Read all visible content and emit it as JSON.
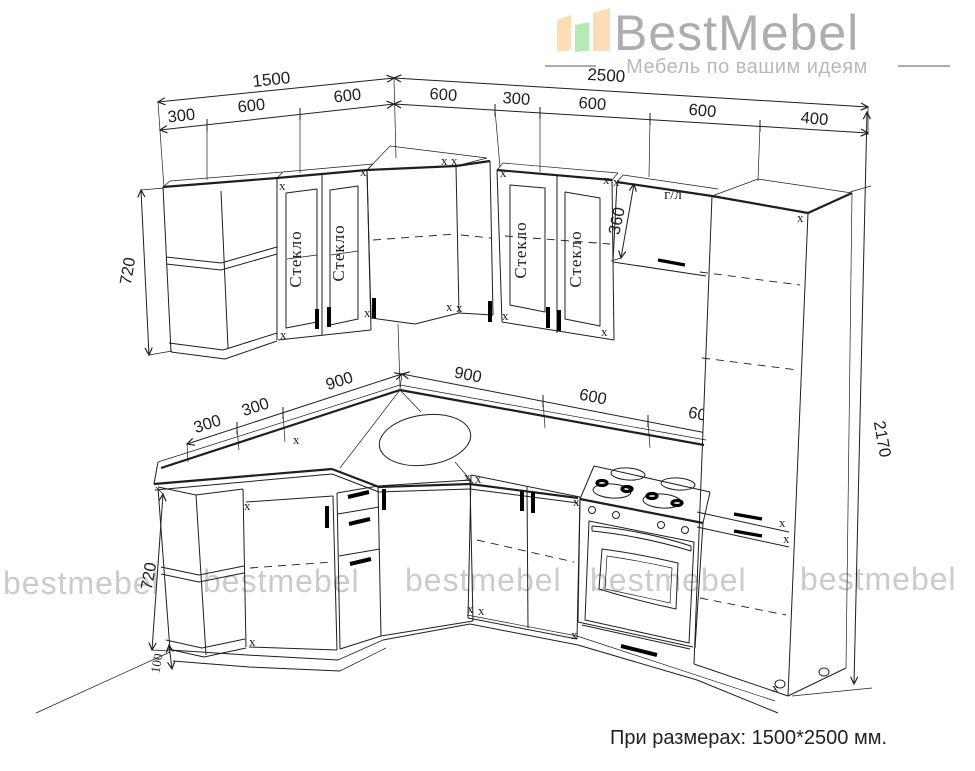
{
  "logo": {
    "name": "BestMebel",
    "tagline": "Мебель по вашим идеям"
  },
  "watermark": {
    "text": "bestmebel"
  },
  "footer": {
    "note": "При размерах: 1500*2500 мм."
  },
  "labels": {
    "glass": "Стекло",
    "gas_lift": "г/л",
    "corner_mark": "x"
  },
  "colors": {
    "line": "#1f1f1f",
    "watermark": "#cbcbcb",
    "logo_text": "#adadad",
    "logo_bar_left": "#fadeb4",
    "logo_bar_mid": "#b6eab4",
    "logo_bar_right": "#fcdeb6",
    "tagline": "#b9b9b9"
  },
  "dims": {
    "left_wall_total": "1500",
    "right_wall_total": "2500",
    "left_wall_segments": [
      "300",
      "600",
      "600"
    ],
    "right_wall_segments": [
      "600",
      "300",
      "600",
      "600",
      "400"
    ],
    "wall_cabinet_height": "720",
    "gas_lift_cabinet_height": "360",
    "tall_cabinet_height": "2170",
    "counter_left_segments": [
      "300",
      "300",
      "900"
    ],
    "counter_right_segments": [
      "900",
      "600",
      "600"
    ],
    "base_cabinet_height": "720",
    "plinth_height": "100"
  }
}
